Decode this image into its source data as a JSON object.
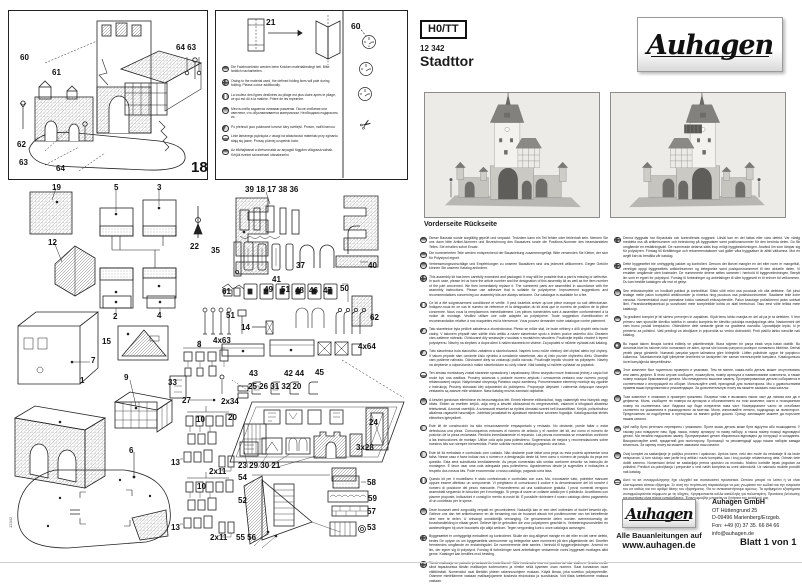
{
  "header": {
    "scale": "H0/TT",
    "article_number": "12 342",
    "product_name": "Stadttor",
    "brand": "Auhagen"
  },
  "photos": {
    "caption": "Vorderseite Rückseite"
  },
  "diagram": {
    "figure_number": "18",
    "labels": [
      "19",
      "5",
      "3",
      "22",
      "12",
      "35",
      "39 18 17 38 36",
      "37",
      "41",
      "40",
      "61",
      "49",
      "51",
      "48",
      "46",
      "47",
      "50",
      "62",
      "51",
      "14",
      "4x63",
      "4x64",
      "43",
      "42 44",
      "45",
      "25 26 31 32 20",
      "2x34",
      "20",
      "24",
      "3x28",
      "2",
      "4",
      "15",
      "7",
      "1",
      "9",
      "8",
      "33",
      "27",
      "10",
      "13",
      "6",
      "2x11",
      "10",
      "13",
      "2x11",
      "23 29 30 21",
      "54",
      "52",
      "55 56",
      "58",
      "59",
      "57",
      "53",
      "60",
      "61",
      "62",
      "63",
      "64",
      "64 63"
    ]
  },
  "fold_note": {
    "part_label": "21",
    "clock_label": "60",
    "texts": [
      {
        "flag": "de",
        "text": "Die Falzbruchlinien werden beim Knicken materialbedingt hell. Bitte farblich nacharbeiten."
      },
      {
        "flag": "gb",
        "text": "Owing to the material used, the defined folding lines will pale during folding. Please colour additionally."
      },
      {
        "flag": "fr",
        "text": "La couleur des lignes destinées au pliage est plus claire après le pliage, ce qui est dû à la matière. Prière de les repeindre."
      },
      {
        "flag": "ru",
        "text": "Места сгиба задаются линиями разметки. После сгибания они светлеют, что обуславливается материалом. Необходимо подкрасить их."
      },
      {
        "flag": "cz",
        "text": "Po přehnutí jsou polámané lomové čáry světlejší. Prosím, natřít barvou."
      },
      {
        "flag": "pl",
        "text": "Linie łamanego pęknięcia z uwagi na właściwości materiału przy zginaniu stają się jasne. Proszę później uzupełnić kolor."
      },
      {
        "flag": "hu",
        "text": "Az élkihajtásnál a törésvonalak az anyagtól függően világossá válnak. Kérjük ezeket színezéssel utánakezelni."
      }
    ]
  },
  "instructions": {
    "left": [
      {
        "flag": "de",
        "text": "Dieser Bausatz wurde sorgfältig geprüft und verpackt. Trotzdem kann ein Teil fehlen oder fehlerhaft sein. Nennen Sie uns dann bitte Artikel-Nummer und Bezeichnung des Bausatzes sowie die Positions-Nummer des beanstandeten Teiles. Sie erhalten sofort Ersatz."
      },
      {
        "flag": "de",
        "text": "Die nummerierten Teile werden entsprechend der Bauanleitung zusammengefügt. Bitte verwenden Sie Kleber, der sich für Polystyrol eignet."
      },
      {
        "flag": "de",
        "text": "Verbesserungsvorschläge und Empfehlungen zu unseren Bausätzen sind uns jederzeit willkommen. Gegen Gebühr können Sie unseren Katalog anfordern."
      },
      {
        "flag": "gb",
        "text": "This assembly kit has been carefully examined and packaged. It may still be possible that a part is missing or defective. In such case, please let us have the article number and the designation of this assembly kit as well as the item number of the part concerned. We then immediately replace it. The numbered parts are assembled in accordance with the assembly instructions. Please use adhesive that is suitable for polystyrene. Improvement suggestions and recommendations concerning our assembly kits are always welcome. Our catalogue is available for a fee."
      },
      {
        "flag": "fr",
        "text": "Ce kit a été soigneusement conditionné et vérifié. Il peut toutefois arriver qu'une pièce manque ou soit défectueuse. Indiquez-nous en ce cas le numéro de référence et la désignation du kit ainsi que le numéro de position de la pièce concernée. Nous vous la remplacerons immédiatement. Les pièces numérotées sont à assembler conformément à la notice de montage. Veuillez utiliser une colle adaptée au polystyrène. Toute suggestion d'amélioration et recommandation relative à nos maquettes est la bienvenue. Vous pouvez demander notre catalogue contre paiement."
      },
      {
        "flag": "cz",
        "text": "Tato stavebnice byla pečlivě zabalena a zkontrolována. Přesto se může stát, že bude některý z dílů chybět nebo bude vadný. V takovém případě nám sdělte číslo artiklu a název stavebnice spolu s číslem pozice vadného dílu. Obratem vám zašleme náhradu. Očíslované díly sestavujte v souladu s montážním návodem. Používejte lepidlo vhodné k lepení polystyrenu. Návrhy na zlepšení a doporučení k našim stavebnicím vítáme. Za poplatek si můžete vyžádat náš katalog."
      },
      {
        "flag": "sk",
        "text": "Táto stavebnica bola starostlivo zabalená a skontrolovaná. Napriek tomu môže niektorý diel chýbať alebo byť chybný. V takom prípade nám oznámte číslo výrobku a označenie stavebnice, ako aj číslo pozície chybného dielu. Okamžite vám pošleme náhradu. Očíslované diely sa zostavujú podľa návodu. Používajte lepidlo vhodné na polystyrén. Návrhy na zlepšenie a odporúčania k našim stavebniciam sú vždy vítané. Náš katalóg si môžete vyžiadať za poplatok."
      },
      {
        "flag": "pl",
        "text": "Ten zestaw montażowy został starannie sprawdzony i zapakowany. Mimo wszystko może brakować jednej z części lub może być ona wadliwa. Prosimy wówczas o podanie numeru artykułu i oznaczenia zestawu oraz numeru pozycji reklamowanej części. Natychmiast otrzymają Państwo część zamienną. Ponumerowane elementy montuje się zgodnie z instrukcją. Prosimy stosować klej odpowiedni do polistyrenu. Propozycje ulepszeń i zalecenia dotyczące naszych zestawów są zawsze mile widziane. Nasz katalog można zamówić odpłatnie."
      },
      {
        "flag": "hu",
        "text": "A készlet gondosan ellenőrizve és becsomagolva lett. Ennek ellenére előfordulhat, hogy valamelyik rész hiányzik vagy hibás. Ebben az esetben kérjük, adja meg a készlet cikkszámát és megnevezését, valamint a kifogásolt alkatrész tételszámát. Azonnal cseréljük. A számozott részeket az építési útmutató szerint kell összeállítani. Kérjük, polisztirolhoz alkalmas ragasztót használjon. Jobbítási javaslatait és ajánlásait mindenkor szívesen fogadjuk. Katalógusunkat térítés ellenében igényelheti."
      },
      {
        "flag": "es",
        "text": "Este kit de construcción ha sido minuciosamente empaquetado y revisado. No obstante, puede faltar o estar defectuosa una pieza. Comuníquenos entonces el número de artículo y el nombre del kit, así como el número de posición de la pieza reclamada. Recibirá inmediatamente el repuesto. Las piezas numeradas se ensamblan conforme a las instrucciones de montaje. Utilice cola apta para poliestireno. Sugerencias de mejora y recomendaciones sobre nuestros kits son siempre bienvenidas. Puede solicitar nuestro catálogo pagando una tasa."
      },
      {
        "flag": "pt",
        "text": "Este kit foi embalado e controlado com cuidado. Não obstante pode faltar uma peça ou esta poderá apresentar uma falha. Nesse caso é favor indicar-nos o número e a designação deste kit, bem como o número de posição da peça em questão. Esta será substituída imediatamente. As peças numeradas são unidas conforme descrito na instrução de montagem. É favor usar uma cola adequada para poliestireno. Agradecemos desde já sugestões e indicações a respeito dos nossos kits. Pode encomendar o nosso catálogo, pagando uma taxa."
      },
      {
        "flag": "it",
        "text": "Questo kit per il modellismo è stato confezionato e controllato con cura. Ma, nonostante tutto, potrebbe mancare oppure essere difettoso un componente. Vi preghiamo di comunicarci il codice e la denominazione del kit nonché il numero di posizione del pezzo mancante. Provvederemo ad una sostituzione gratuita. I pezzi numerati vengono assemblati seguendo le istruzioni per il montaggio. Si prega di usare un collante adatto per il polistirolo. Accettiamo con piacere proposte, indicazioni e consigli in merito ai nostri kit. È possibile richiedere il nostro catalogo dietro pagamento di un contributo per le spese."
      },
      {
        "flag": "nl",
        "text": "Deze bouwset werd zorgvuldig verpakt en gecontroleerd. Natuurlijk kan er een deel ontbreken of foutief bewerkt zijn. Gelieve ons dan het artikelnummer en de benaming van de bouwset alsook het positienummer van het betreffende deel mee te delen. U ontvangt onmiddellijk vervanging. De genummerde delen worden overeenkomstig de bouwhandleiding in elkaar gezet. Gelieve lijm te gebruiken die voor polystyreen geschikt is. Verbeteringsvoorstellen en aanbevelingen bij onze bouwsets zijn altijd welkom. Tegen vergoeding kunt u onze catalogus aanvragen."
      },
      {
        "flag": "dk",
        "text": "Byggesættet er omhyggeligt emballeret og kontrolleret. Skulle der dog alligevel mangle en del eller en del være defekt, bedes De oplyse os om byggesættets varenummer og betegnelse samt nummeret på den pågældende del. Derefter fremsendes omgående en erstatningsdel. De nummererede dele samles i henhold til byggevejledningen. Anvend en lim, der egner sig til polystyrol. Forslag til forbedringer samt anbefalinger vedrørende vores byggesæt modtages altid gerne. Kataloget kan bestilles mod betaling."
      },
      {
        "flag": "fi",
        "text": "Tämä mallisarja on pakattu ja tarkastettu huolellisesti. Siitä huolimatta osa voi puuttua tai olla viallinen. Ilmoita meille siinä tapauksessa tämän mallisarjan tuotenumero ja nimike sekä kyseisen osan numero. Saat korvaavan osan välittömästi. Numeroidut osat liitetään yhteen rakennusohjeen mukaan. Käytä liimaa, joka soveltuu polystyreenille. Otamme mielellämme vastaan mallisarjojamme koskevia ehdotuksia ja suosituksia. Voit tilata luettelomme maksua vastaan."
      }
    ],
    "right": [
      {
        "flag": "se",
        "text": "Denna byggsats har förpackats och kontrollerats noggrant. Likväl kan en del fattas eller vara defekt. Var vänlig meddela oss då artikelnummer och beteckning på byggsatsen samt positionsnummer för den berörda delen. Du får omgående en ersättningsdel. De numrerade delarna sätts ihop enligt byggbeskrivningen. Använd lim som lämpar sig för polystyren. Förslag till förbättringar och rekommendationer vad gäller våra byggsatser är alltid välkomna. Mot en avgift kan du beställa vår katalog."
      },
      {
        "flag": "no",
        "text": "Dette byggesettet ble omhyggelig pakket og kontrollert. Dersom det likevel mangler en del eller noen er mangelfull, vennligst oppgi byggesettets artikkelnummer og betegnelse samt posisjonsnummeret til den aktuelle delen. Vi erstatter omgående uten kostnader. De nummererte delene settes sammen i henhold til byggeveiledningen. Benytt lim som er egnet for polystyrol. Forslag til forbedringer og anbefalinger til våre byggesett er til enhver tid velkommen. Du kan bestille katalogen vår mot et gebyr."
      },
      {
        "flag": "ee",
        "text": "See ehituskomplekt on hoolikalt pakitud ja kontrollitud. Siiski võib mõni osa puududa või olla defektne. Sel juhul teatage meile palun komplekti artiklinumber ja nimetus ning puuduva osa positsiooninumber. Saadame teile kohe varuosa. Nummerdatud osad pannakse kokku vastavalt ehitusjuhendile. Palun kasutage polüstüreeni jaoks sobivat liimi. Parandusettepanekud ja soovitused meie komplektide kohta on alati teretulnud. Tasu eest võite tellida meie kataloogi."
      },
      {
        "flag": "si",
        "text": "Ta gradbeni komplet je bil skrbno preverjen in zapakiran. Kljub temu lahko manjka en del ali pa je ta defekten. V tem primeru nam sporočite številko izdelka in oznako kompleta ter številko položaja manjkajočega dela. Nadomestni del vam bomo poslali brezplačno. Oštevilčene dele sestavite glede na gradbena navodila. Uporabljajte lepilo, ki je primerno za polistirol. Vaši predlogi za izboljšave in priporočila so vedno dobrodošli. Proti plačilu lahko naročite naš katalog."
      },
      {
        "flag": "tr",
        "text": "Bu inşaat takımı itinayla kontrol edilmiş ve paketlenmiştir. Buna rağmen bir parça eksik veya hatalı olabilir. Bu durumda bize bu takımın ürün numarasını ve adını, ayrıca söz konusu parçanın pozisyon numarasını bildiriniz. Derhal yedek parça gönderilir. Numaralı parçalar yapım talimatına göre birleştirilir. Lütfen polistirole uygun bir yapıştırıcı kullanınız. Takımlarımızla ilgili iyileştirme önerilerini ve tavsiyeleri her zaman memnuniyetle karşılarız. Katalogumuzu ücret karşılığında isteyebilirsiniz."
      },
      {
        "flag": "ru",
        "text": "Этот комплект был тщательно проверен и упакован. Тем не менее, какая-либо деталь может отсутствовать или иметь дефект. В этом случае сообщите, пожалуйста, номер артикула и наименование комплекта, а также номер позиции бракованной детали. Мы немедленно вышлем замену. Пронумерованные детали собираются в соответствии с инструкцией по сборке. Используйте клей, пригодный для полистирола. Мы с удовольствием примем ваши предложения и рекомендации. За дополнительную плату вы можете заказать наш каталог."
      },
      {
        "flag": "bg",
        "text": "Този комплект е опакован и проверен грижливо. Въпреки това е възможно някоя част да липсва или да е дефектна. Моля, съобщете ни номера на артикула и обозначението на този комплект, както и позиционния номер на съответната част. Веднага ще бъде изпратена нова част. Номерираните части се сглобяват съответно на указанията в ръководството за монтаж. Моля, използвайте лепило, подходящо за полистирол. Предложения за подобрения и препоръки са винаги добре дошли. Срещу заплащане можете да поръчате нашия каталог."
      },
      {
        "flag": "ua",
        "text": "Цей набір було ретельно перевірено і упаковано. Проте якась деталь може бути відсутня або пошкоджена. У такому разі повідомте нам, будь ласка, номер артикулу та назву набору, а також номер позиції відповідної деталі. Ми негайно надішлемо заміну. Пронумеровані деталі збираються відповідно до інструкції зі складання. Використовуйте клей, придатний для полістиролу. Пропозиції та рекомендації щодо наших наборів завжди вітаються. За окрему плату ви можете замовити наш каталог."
      },
      {
        "flag": "rs",
        "text": "Ovaj komplet za sastavljanje je pažljivo proveren i upakovan. Uprkos tome, neki deo može da nedostaje ili da bude neispravan. U tom slučaju nam javite broj artikla i naziv kompleta, kao i broj pozicije reklamiranog dela. Odmah ćete dobiti zamenu. Numerisani delovi se sastavljaju prema uputstvu za montažu. Molimo koristite lepak pogodan za polistirol. Predlozi za poboljšanja i preporuke u vezi naših kompleta su uvek dobrodošli. Uz naknadu možete poručiti naš katalog."
      },
      {
        "flag": "gr",
        "text": "Αυτό το κιτ συναρμολόγησης έχει ελεγχθεί και συσκευαστεί προσεκτικά. Ωστόσο μπορεί να λείπει ή να είναι ελαττωματικό κάποιο εξάρτημα. Σε αυτή την περίπτωση παρακαλούμε να μας γνωρίσετε τον κωδικό και την ονομασία του κιτ καθώς και τον αριθμό θέσης του εξαρτήματος. Θα το αντικαταστήσουμε αμέσως. Τα αριθμημένα εξαρτήματα συναρμολογούνται σύμφωνα με τις οδηγίες. Χρησιμοποιείτε κόλλα κατάλληλη για πολυστερίνη. Προτάσεις βελτίωσης και συστάσεις είναι πάντα ευπρόσδεκτες. Έναντι αμοιβής μπορείτε να ζητήσετε τον κατάλογό μας."
      }
    ]
  },
  "footer": {
    "brand": "Auhagen",
    "tagline_line1": "Alle Bauanleitungen auf",
    "tagline_line2": "www.auhagen.de",
    "company": "Auhagen GmbH",
    "address_line1": "OT Hüttengrund 25",
    "address_line2": "D-09496 Marienberg/Erzgeb.",
    "address_line3": "Fon: +49 (0) 37 35. 66 84 66",
    "address_line4": "info@auhagen.de",
    "sheet_label": "Blatt 1 von 1"
  },
  "page": {
    "print_code": "12342"
  },
  "icons": {
    "scissors": "✂"
  },
  "colors": {
    "ink": "#1a1a1a",
    "paper": "#ffffff",
    "photo_background": "#ecebe8",
    "roof_gray": "#83817d"
  }
}
